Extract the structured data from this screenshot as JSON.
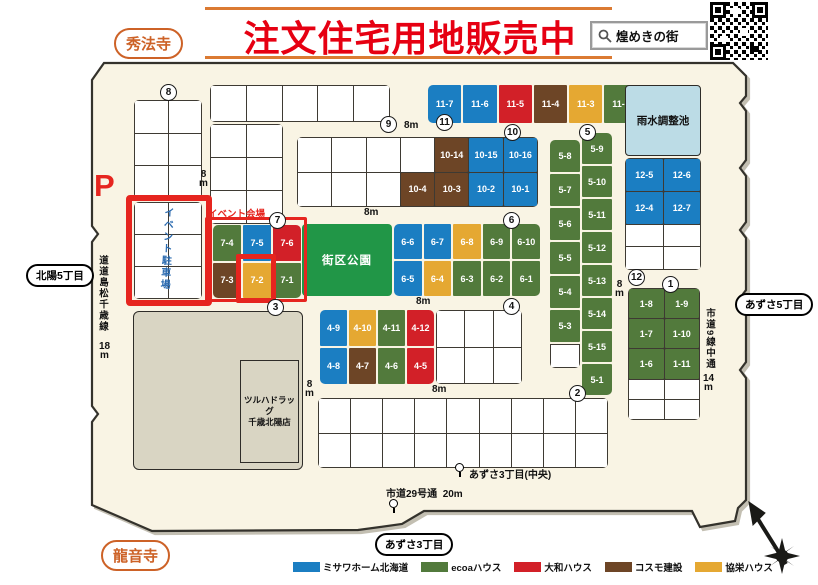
{
  "header": {
    "title": "注文住宅用地販売中",
    "search_label": "煌めきの街",
    "temple_top_left": "秀法寺",
    "temple_bottom_left": "龍音寺"
  },
  "legend": {
    "items": [
      {
        "label": "ミサワホーム北海道",
        "builder": "misawa"
      },
      {
        "label": "ecoaハウス",
        "builder": "ecoa"
      },
      {
        "label": "大和ハウス",
        "builder": "daiwa"
      },
      {
        "label": "コスモ建設",
        "builder": "cosmo"
      },
      {
        "label": "協栄ハウス",
        "builder": "kyoei"
      }
    ],
    "colors": {
      "misawa": "#1b7ec2",
      "ecoa": "#527a3c",
      "daiwa": "#d22028",
      "cosmo": "#6d4526",
      "kyoei": "#e5a832"
    }
  },
  "map": {
    "park_label": "街区公園",
    "pond_label": "雨水調整池",
    "event_site_label": "イベント会場",
    "event_parking_label": "イベント駐車場",
    "parking_mark": "P",
    "store_line1": "ツルハドラッグ",
    "store_line2": "千歳北陽店",
    "ovals": {
      "hokuyo": "北陽5丁目",
      "azusa5": "あずさ5丁目",
      "azusa3": "あずさ3丁目"
    },
    "labels": {
      "m8": "8m",
      "m14": "14m",
      "m18": "18m",
      "m20": "20m",
      "road_west": "道道島松千歳線",
      "road_east": "市道9線中通",
      "road_south": "市道29号通",
      "busstop_center": "あずさ3丁目(中央)"
    },
    "circles": {
      "c1": "1",
      "c2": "2",
      "c3": "3",
      "c4": "4",
      "c5": "5",
      "c6": "6",
      "c7": "7",
      "c8": "8",
      "c9": "9",
      "c10": "10",
      "c11": "11",
      "c12": "12"
    },
    "blocks": {
      "b11": {
        "cells": [
          {
            "l": "11-7",
            "b": "misawa"
          },
          {
            "l": "11-6",
            "b": "misawa"
          },
          {
            "l": "11-5",
            "b": "daiwa"
          },
          {
            "l": "11-4",
            "b": "cosmo"
          },
          {
            "l": "11-3",
            "b": "kyoei"
          },
          {
            "l": "11-2",
            "b": "ecoa"
          },
          {
            "l": "11-1",
            "b": "ecoa"
          }
        ]
      },
      "b10": {
        "cells": [
          {},
          {},
          {},
          {},
          {
            "l": "10-14",
            "b": "cosmo"
          },
          {
            "l": "10-15",
            "b": "misawa"
          },
          {
            "l": "10-16",
            "b": "misawa"
          },
          {},
          {},
          {},
          {
            "l": "10-4",
            "b": "cosmo"
          },
          {
            "l": "10-3",
            "b": "cosmo"
          },
          {
            "l": "10-2",
            "b": "misawa"
          },
          {
            "l": "10-1",
            "b": "misawa"
          }
        ]
      },
      "b12": {
        "cells": [
          {
            "l": "12-5",
            "b": "misawa"
          },
          {
            "l": "12-6",
            "b": "misawa"
          },
          {
            "l": "12-4",
            "b": "misawa"
          },
          {
            "l": "12-7",
            "b": "misawa"
          },
          {},
          {},
          {},
          {}
        ]
      },
      "b5L": {
        "cells": [
          {
            "l": "5-8",
            "b": "ecoa"
          },
          {
            "l": "5-7",
            "b": "ecoa"
          },
          {
            "l": "5-6",
            "b": "ecoa"
          },
          {
            "l": "5-5",
            "b": "ecoa"
          },
          {
            "l": "5-4",
            "b": "ecoa"
          },
          {
            "l": "5-3",
            "b": "ecoa"
          },
          {}
        ]
      },
      "b5R": {
        "cells": [
          {
            "l": "5-9",
            "b": "ecoa"
          },
          {
            "l": "5-10",
            "b": "ecoa"
          },
          {
            "l": "5-11",
            "b": "ecoa"
          },
          {
            "l": "5-12",
            "b": "ecoa"
          },
          {
            "l": "5-13",
            "b": "ecoa"
          },
          {
            "l": "5-14",
            "b": "ecoa"
          },
          {
            "l": "5-15",
            "b": "ecoa"
          },
          {
            "l": "5-1",
            "b": "ecoa"
          }
        ]
      },
      "b6": {
        "cells": [
          {
            "l": "6-6",
            "b": "misawa"
          },
          {
            "l": "6-7",
            "b": "misawa"
          },
          {
            "l": "6-8",
            "b": "kyoei"
          },
          {
            "l": "6-9",
            "b": "ecoa"
          },
          {
            "l": "6-10",
            "b": "ecoa"
          },
          {
            "l": "6-5",
            "b": "misawa"
          },
          {
            "l": "6-4",
            "b": "kyoei"
          },
          {
            "l": "6-3",
            "b": "ecoa"
          },
          {
            "l": "6-2",
            "b": "ecoa"
          },
          {
            "l": "6-1",
            "b": "ecoa"
          }
        ]
      },
      "b7": {
        "cells": [
          {
            "l": "7-4",
            "b": "ecoa"
          },
          {
            "l": "7-5",
            "b": "misawa"
          },
          {
            "l": "7-6",
            "b": "daiwa"
          },
          {
            "l": "7-3",
            "b": "cosmo"
          },
          {
            "l": "7-2",
            "b": "kyoei"
          },
          {
            "l": "7-1",
            "b": "ecoa"
          }
        ]
      },
      "b4c": {
        "cells": [
          {
            "l": "4-9",
            "b": "misawa"
          },
          {
            "l": "4-10",
            "b": "kyoei"
          },
          {
            "l": "4-11",
            "b": "ecoa"
          },
          {
            "l": "4-12",
            "b": "daiwa"
          },
          {
            "l": "4-8",
            "b": "misawa"
          },
          {
            "l": "4-7",
            "b": "cosmo"
          },
          {
            "l": "4-6",
            "b": "ecoa"
          },
          {
            "l": "4-5",
            "b": "daiwa"
          }
        ]
      },
      "b4w": {
        "cells": [
          {},
          {},
          {},
          {},
          {},
          {}
        ]
      },
      "b1": {
        "cells": [
          {
            "l": "1-8",
            "b": "ecoa"
          },
          {
            "l": "1-9",
            "b": "ecoa"
          },
          {
            "l": "1-7",
            "b": "ecoa"
          },
          {
            "l": "1-10",
            "b": "ecoa"
          },
          {
            "l": "1-6",
            "b": "ecoa"
          },
          {
            "l": "1-11",
            "b": "ecoa"
          },
          {},
          {},
          {},
          {}
        ]
      },
      "b2": {
        "cells": [
          {},
          {},
          {},
          {},
          {},
          {},
          {},
          {},
          {},
          {},
          {},
          {},
          {},
          {},
          {},
          {},
          {},
          {}
        ]
      },
      "b8top": {
        "cells": [
          {},
          {},
          {},
          {},
          {},
          {}
        ]
      },
      "b8red": {
        "cells": [
          {},
          {},
          {},
          {},
          {},
          {}
        ]
      },
      "b9top": {
        "cells": [
          {},
          {},
          {},
          {},
          {}
        ]
      },
      "b9left": {
        "cells": [
          {},
          {},
          {},
          {},
          {},
          {}
        ]
      }
    }
  }
}
